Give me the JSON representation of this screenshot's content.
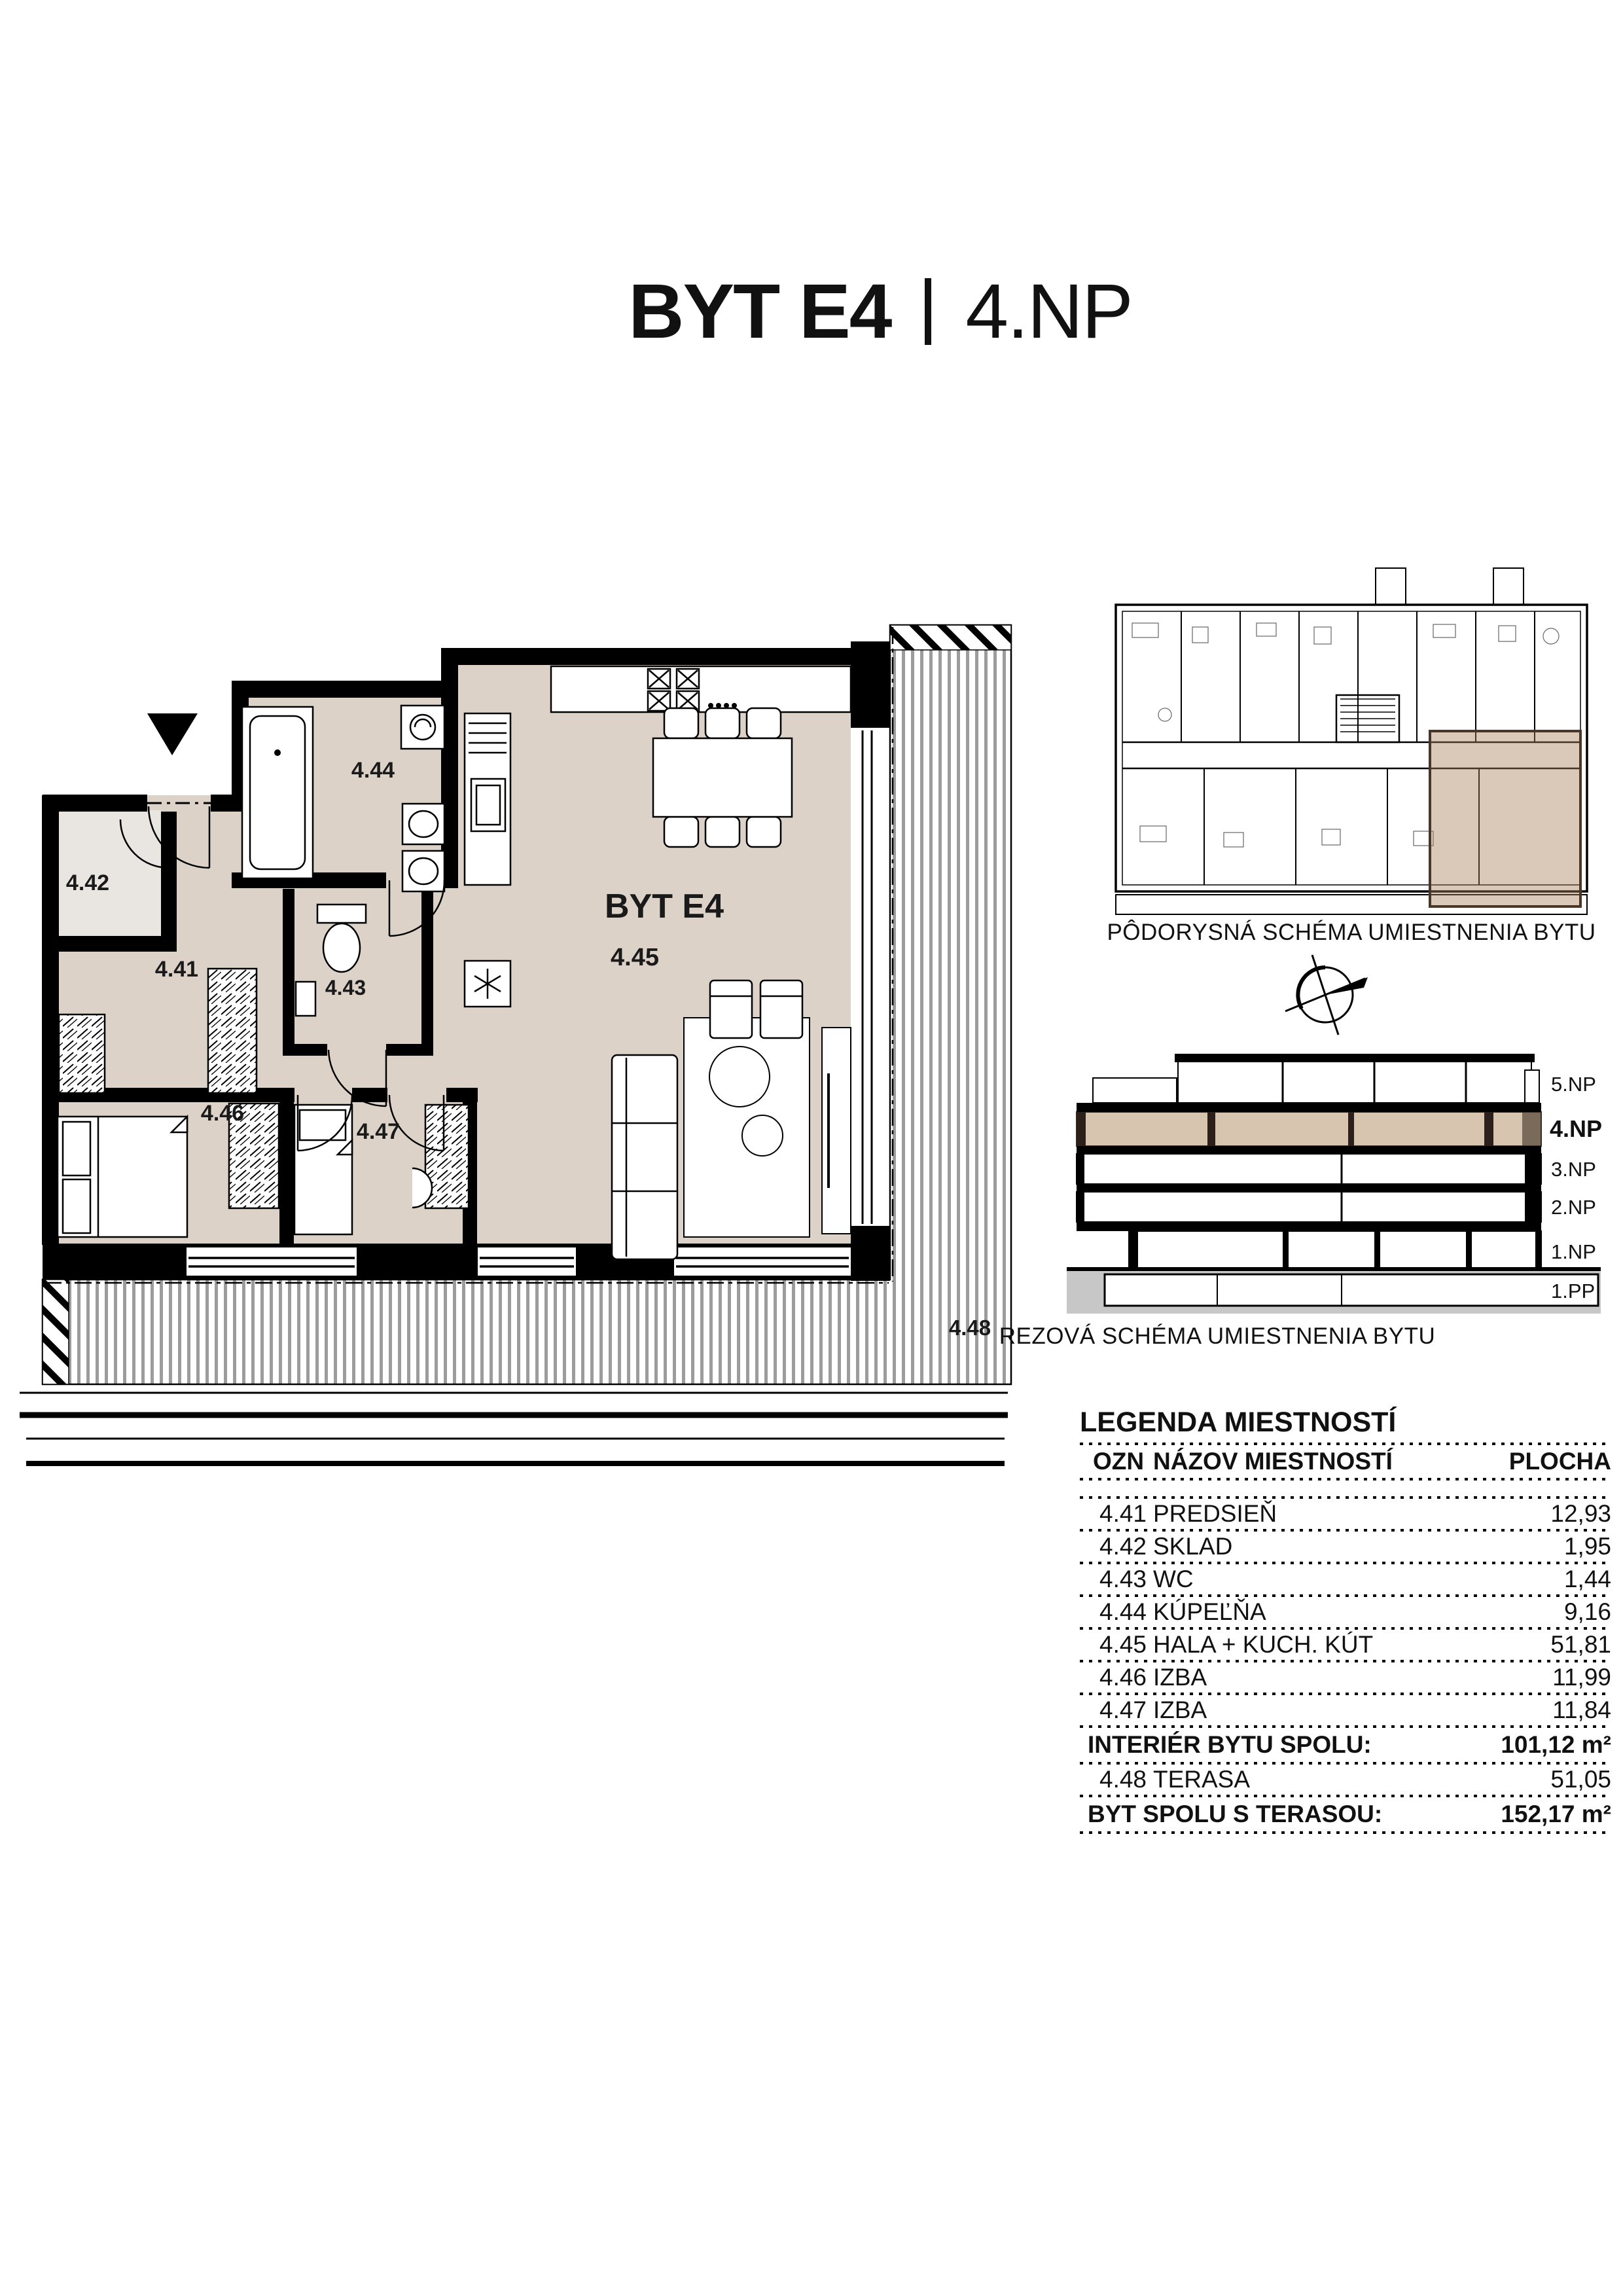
{
  "page": {
    "title_main": "BYT E4",
    "title_floor": "4.NP"
  },
  "plan": {
    "apartment_label": "BYT E4",
    "rooms": {
      "r41": "4.41",
      "r42": "4.42",
      "r43": "4.43",
      "r44": "4.44",
      "r45": "4.45",
      "r46": "4.46",
      "r47": "4.47",
      "r48": "4.48"
    }
  },
  "floor_plan_schema": {
    "caption": "PÔDORYSNÁ SCHÉMA UMIESTNENIA BYTU"
  },
  "section_schema": {
    "caption": "REZOVÁ SCHÉMA UMIESTNENIA BYTU",
    "floors": [
      "5.NP",
      "4.NP",
      "3.NP",
      "2.NP",
      "1.NP",
      "1.PP"
    ],
    "highlighted_floor": "4.NP"
  },
  "legend": {
    "title": "LEGENDA MIESTNOSTÍ",
    "headers": {
      "ozn": "OZN",
      "nazov": "NÁZOV MIESTNOSTÍ",
      "plocha": "PLOCHA"
    },
    "rows": [
      {
        "ozn": "4.41",
        "nazov": "PREDSIEŇ",
        "plocha": "12,93"
      },
      {
        "ozn": "4.42",
        "nazov": "SKLAD",
        "plocha": "1,95"
      },
      {
        "ozn": "4.43",
        "nazov": "WC",
        "plocha": "1,44"
      },
      {
        "ozn": "4.44",
        "nazov": "KÚPEĽŇA",
        "plocha": "9,16"
      },
      {
        "ozn": "4.45",
        "nazov": "HALA + KUCH. KÚT",
        "plocha": "51,81"
      },
      {
        "ozn": "4.46",
        "nazov": "IZBA",
        "plocha": "11,99"
      },
      {
        "ozn": "4.47",
        "nazov": "IZBA",
        "plocha": "11,84"
      }
    ],
    "interior_total_label": "INTERIÉR BYTU SPOLU:",
    "interior_total_value": "101,12 m²",
    "terasa_row": {
      "ozn": "4.48",
      "nazov": "TERASA",
      "plocha": "51,05"
    },
    "total_label": "BYT SPOLU S TERASOU:",
    "total_value": "152,17 m²"
  },
  "colors": {
    "room_fill": "#dcd2c8",
    "sklad_fill": "#e9e6e2",
    "floor_highlight": "#d8c5b0",
    "mini_plan_highlight": "rgba(167,124,86,0.42)",
    "ground_gray": "#c7c7c7",
    "slat_gray": "#9c9c9c"
  }
}
